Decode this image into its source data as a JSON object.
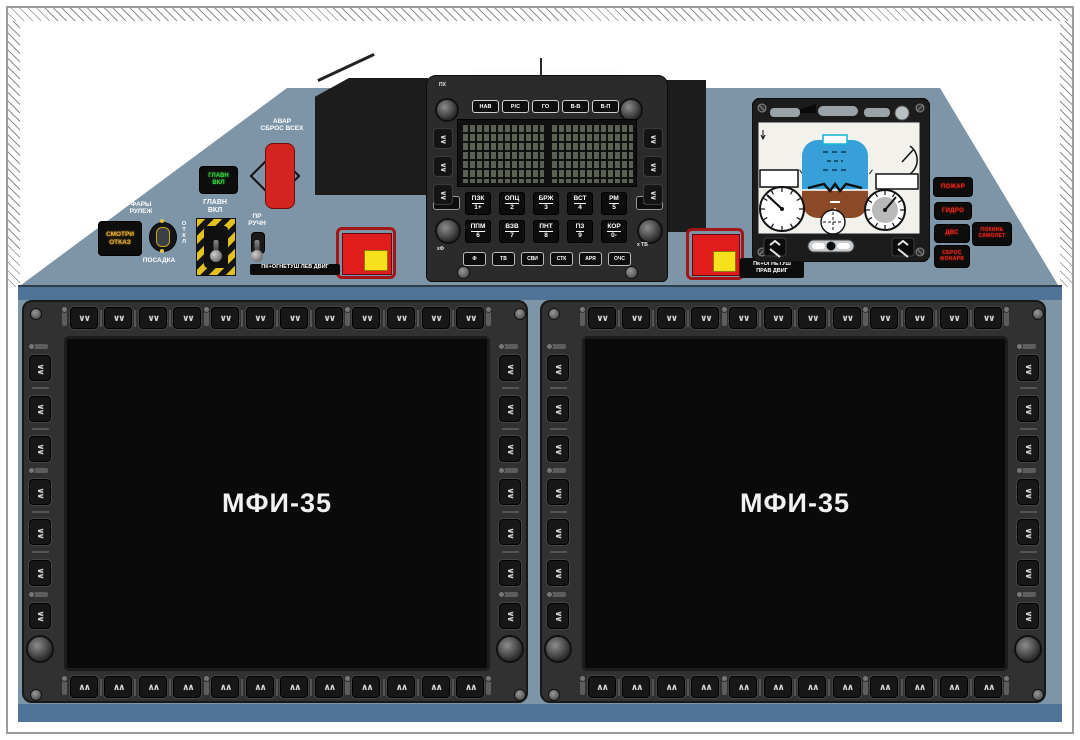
{
  "panel_colors": {
    "main": "#7e94a7",
    "band": "#4f7498",
    "bezel": "#313131",
    "screen": "#0a0a0a",
    "fire_red": "#e01c1c",
    "fire_yellow": "#f6e11c",
    "warn_amber": "#e8b33a",
    "ok_green": "#41d145",
    "warn_red": "#e42a20"
  },
  "upper_panel": {
    "warn_light": {
      "line1": "СМОТРИ",
      "line2": "ОТКАЗ"
    },
    "green_light": {
      "line1": "ГЛАВН",
      "line2": "ВКЛ"
    },
    "lights_switch": {
      "top1": "ФАРЫ",
      "top2": "РУЛЕЖ",
      "right": "ОТКЛ",
      "bottom": "ПОСАДКА"
    },
    "master_switch": {
      "line1": "ГЛАВН",
      "line2": "ВКЛ"
    },
    "pr_switch": {
      "line1": "ПР",
      "line2": "РУЧН"
    },
    "jettison": {
      "line1": "АВАР",
      "line2": "СБРОС ВСЕХ"
    },
    "fire_left_label": "ПК+ОГНЕТУШ ЛЕВ ДВИГ",
    "fire_right_label": {
      "line1": "ПК+ОГНЕТУШ",
      "line2": "ПРАВ ДВИГ"
    }
  },
  "keypad": {
    "corner_label": "ПХ",
    "mode_keys": [
      "НАВ",
      "Р/С",
      "ГО",
      "В-В",
      "В-П"
    ],
    "clear_key": "СБР",
    "exec_key": "ВЫЦ",
    "row1": [
      {
        "label": "ПЗК",
        "num": "1+"
      },
      {
        "label": "ОПЦ",
        "num": "2"
      },
      {
        "label": "БРЖ",
        "num": "3"
      },
      {
        "label": "ВСТ",
        "num": "4"
      },
      {
        "label": "РМ",
        "num": "5"
      }
    ],
    "row2": [
      {
        "label": "ППМ",
        "num": "6"
      },
      {
        "label": "ВЗВ",
        "num": "7"
      },
      {
        "label": "ПНТ",
        "num": "8"
      },
      {
        "label": "ПЗ",
        "num": "9"
      },
      {
        "label": "КОР",
        "num": "0-"
      }
    ],
    "row3": [
      "Ф",
      "ТВ",
      "СВИ",
      "СТК",
      "АРЯ",
      "ОЧС"
    ],
    "label_left": "хФ",
    "label_right": "х ТВ"
  },
  "annunciators_right": {
    "a1": "ПОЖАР",
    "a2": "ГИДРО",
    "a3": "ДВС",
    "a4": {
      "line1": "ПОКИНЬ",
      "line2": "САМОЛЕТ"
    },
    "a5": {
      "line1": "СБРОС",
      "line2": "ФОНАРЯ"
    }
  },
  "displays": {
    "left_title": "МФИ-35",
    "right_title": "МФИ-35",
    "bezel_buttons": {
      "top": 12,
      "bottom": 12,
      "left": 7,
      "right": 7
    },
    "glyph_down": "∨∨",
    "glyph_up": "∧∧"
  }
}
